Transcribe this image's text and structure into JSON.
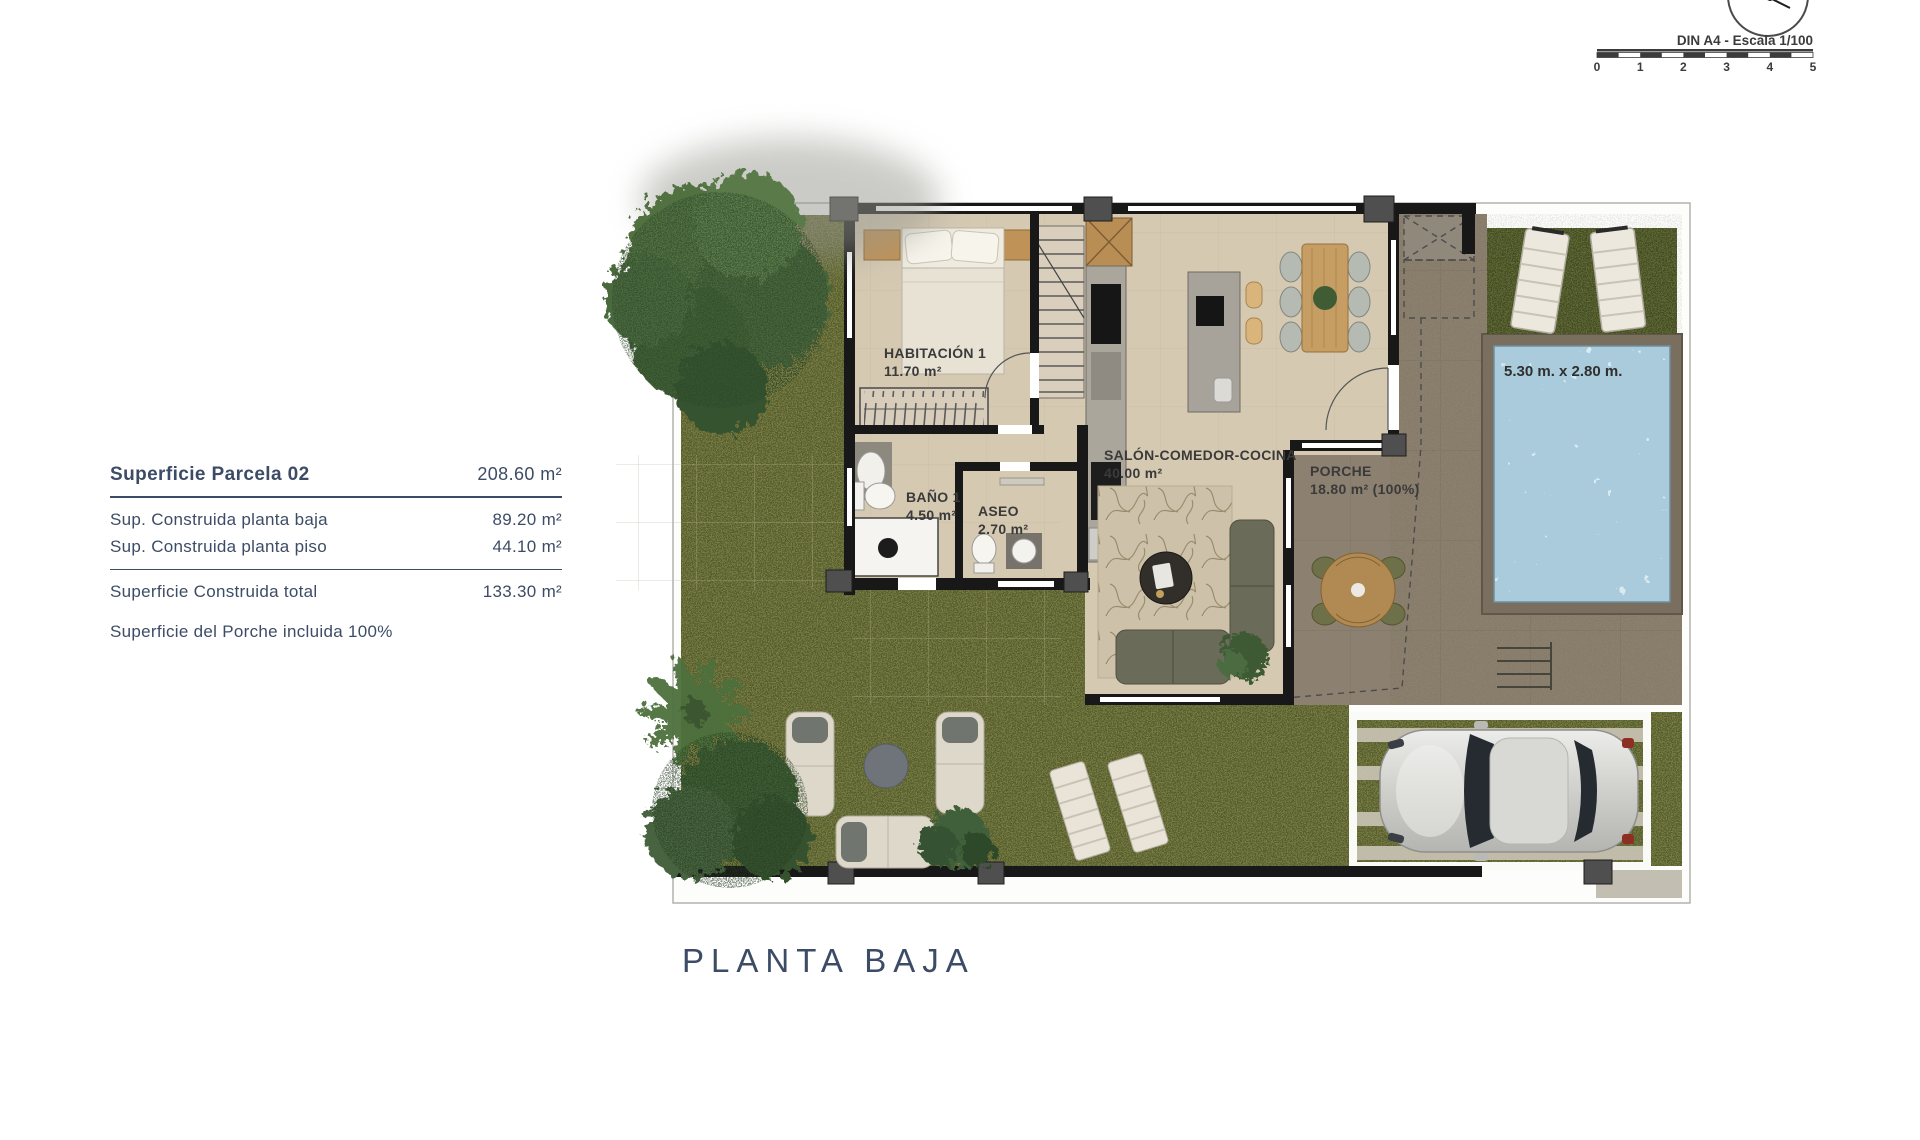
{
  "meta": {
    "scale_label": "DIN A4 - Escala 1/100",
    "scale_ticks": [
      "0",
      "1",
      "2",
      "3",
      "4",
      "5"
    ]
  },
  "info_panel": {
    "title_label": "Superficie Parcela 02",
    "title_value": "208.60 m²",
    "rows": [
      {
        "label": "Sup. Construida planta baja",
        "value": "89.20 m²"
      },
      {
        "label": "Sup. Construida planta piso",
        "value": "44.10 m²"
      }
    ],
    "total_label": "Superficie Construida total",
    "total_value": "133.30 m²",
    "note": "Superficie del Porche incluida 100%"
  },
  "plan": {
    "title": "PLANTA BAJA",
    "rooms": [
      {
        "name": "HABITACIÓN 1",
        "area": "11.70 m²"
      },
      {
        "name": "BAÑO 1",
        "area": "4.50 m²"
      },
      {
        "name": "ASEO",
        "area": "2.70 m²"
      },
      {
        "name": "SALÓN-COMEDOR-COCINA",
        "area": "40.00 m²"
      },
      {
        "name": "PORCHE",
        "area": "18.80 m² (100%)"
      }
    ],
    "pool_dimensions": "5.30 m. x 2.80 m."
  },
  "colors": {
    "accent_navy": "#3d4c66",
    "grass": "#767b43",
    "grass_dark": "#5e6834",
    "floor": "#d5c9b2",
    "terrace": "#8c8070",
    "pool_water": "#a9cbdb",
    "wall": "#181818",
    "label_dark": "#3a3a3a"
  }
}
